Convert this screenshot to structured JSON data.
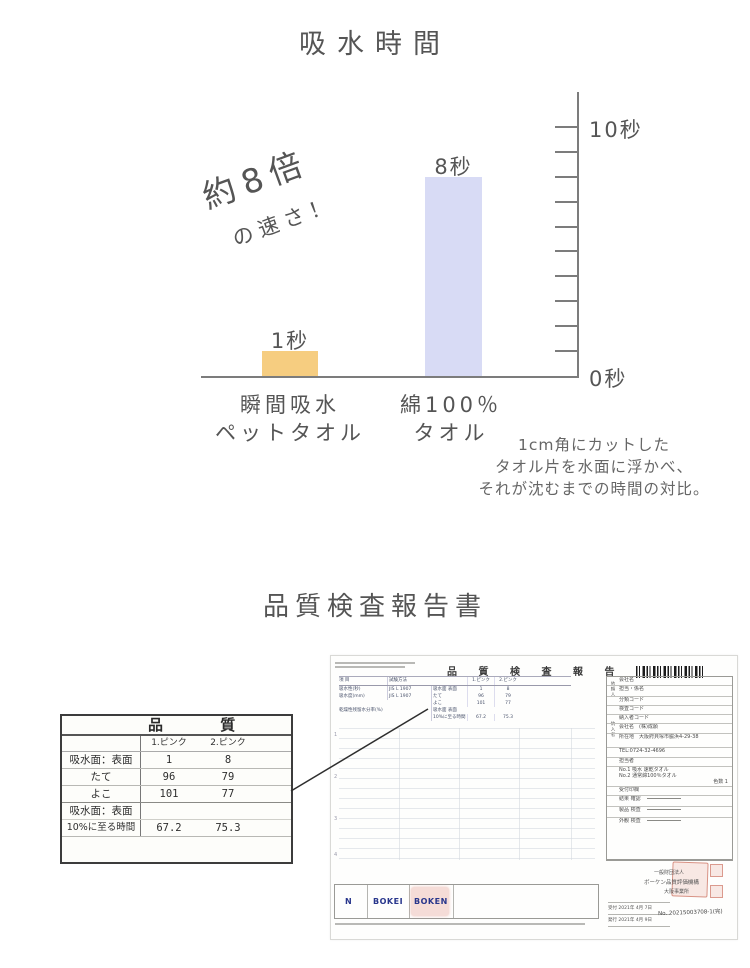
{
  "chart": {
    "title": "吸水時間",
    "promo": {
      "line1": "約8倍",
      "line2": "の速さ！"
    },
    "axis": {
      "max_label": "10秒",
      "min_label": "0秒"
    },
    "bars": [
      {
        "value_label": "1秒",
        "category_line1": "瞬間吸水",
        "category_line2": "ペットタオル"
      },
      {
        "value_label": "8秒",
        "category_line1": "綿100％",
        "category_line2": "タオル"
      }
    ],
    "note_lines": [
      "1cm角にカットした",
      "タオル片を水面に浮かべ、",
      "それが沈むまでの時間の対比。"
    ]
  },
  "chart_data": {
    "type": "bar",
    "title": "吸水時間",
    "categories": [
      "瞬間吸水ペットタオル",
      "綿100%タオル"
    ],
    "values": [
      1,
      8
    ],
    "value_labels": [
      "1秒",
      "8秒"
    ],
    "bar_colors": [
      "#f6cd80",
      "#d8dbf5"
    ],
    "ylabel": "秒",
    "ylim": [
      0,
      10
    ],
    "ytick_step": 1,
    "grid": false,
    "legend": false,
    "annotation": "約8倍の速さ！",
    "note": "1cm角にカットしたタオル片を水面に浮かべ、それが沈むまでの時間の対比。"
  },
  "report": {
    "title": "品質検査報告書",
    "excerpt": {
      "header": "品 質 検",
      "col1": "1.ピンク",
      "col2": "2.ピンク",
      "rows": [
        {
          "label": "吸水面：表面",
          "v1": "1",
          "v2": "8"
        },
        {
          "label": "たて",
          "v1": "96",
          "v2": "79"
        },
        {
          "label": "よこ",
          "v1": "101",
          "v2": "77"
        },
        {
          "label": "吸水面：表面",
          "v1": "",
          "v2": ""
        },
        {
          "label": "10%に至る時間",
          "v1": "67.2",
          "v2": "75.3"
        }
      ]
    },
    "document": {
      "title": "品 質 検 査 報 告 書",
      "table": {
        "col_item": "項 目",
        "col_method": "試験方法",
        "col_s1": "1.ピンク",
        "col_s2": "2.ピンク",
        "rows": [
          {
            "item": "吸水性(秒)",
            "method": "JIS L 1907",
            "sub": "吸水面 表面",
            "v1": "1",
            "v2": "8"
          },
          {
            "item": "吸水度(mm)",
            "method": "JIS L 1907",
            "sub": "たて",
            "v1": "96",
            "v2": "79"
          },
          {
            "item": "",
            "method": "",
            "sub": "よこ",
            "v1": "101",
            "v2": "77"
          },
          {
            "item": "乾燥性残留水分率(%)",
            "method": "",
            "sub": "吸水面 表面",
            "v1": "",
            "v2": ""
          },
          {
            "item": "",
            "method": "",
            "sub": "10%に至る時間",
            "v1": "67.2",
            "v2": "75.3"
          }
        ],
        "row_numbers": [
          "1",
          "2",
          "3",
          "4"
        ]
      },
      "panel": {
        "side_requester": "依頼人",
        "side_supplier": "納入者",
        "requester_rows": [
          "会社名",
          "担当・係名",
          "分類コード",
          "検査コード",
          "納入者コード"
        ],
        "supplier_company": "会社名　(株)成願",
        "supplier_address": "所在地　大阪府貝塚市脇浜4-29-38",
        "supplier_tel": "TEL:0724-32-4696",
        "supplier_person": "担当者",
        "sample1": "No.1 吸水 速乾タオル",
        "sample2": "No.2 通常綿100％タオル",
        "sample_colors": "色数 1",
        "stamp_row": "受付印欄",
        "check_rows": [
          "結果 確認",
          "製品 検査",
          "外観 検査"
        ]
      },
      "footer": {
        "logo_n": "N",
        "logo_bokei": "BOKEI",
        "logo_boken": "BOKEN",
        "org_line1": "一般財団法人",
        "org_line2": "ボーケン品質評価機構",
        "org_line3": "大阪事業所",
        "received": "受付 2021年 4月 7日",
        "issued": "発行 2021年 4月 9日",
        "number": "No. 20215003708-1(完)"
      }
    }
  }
}
